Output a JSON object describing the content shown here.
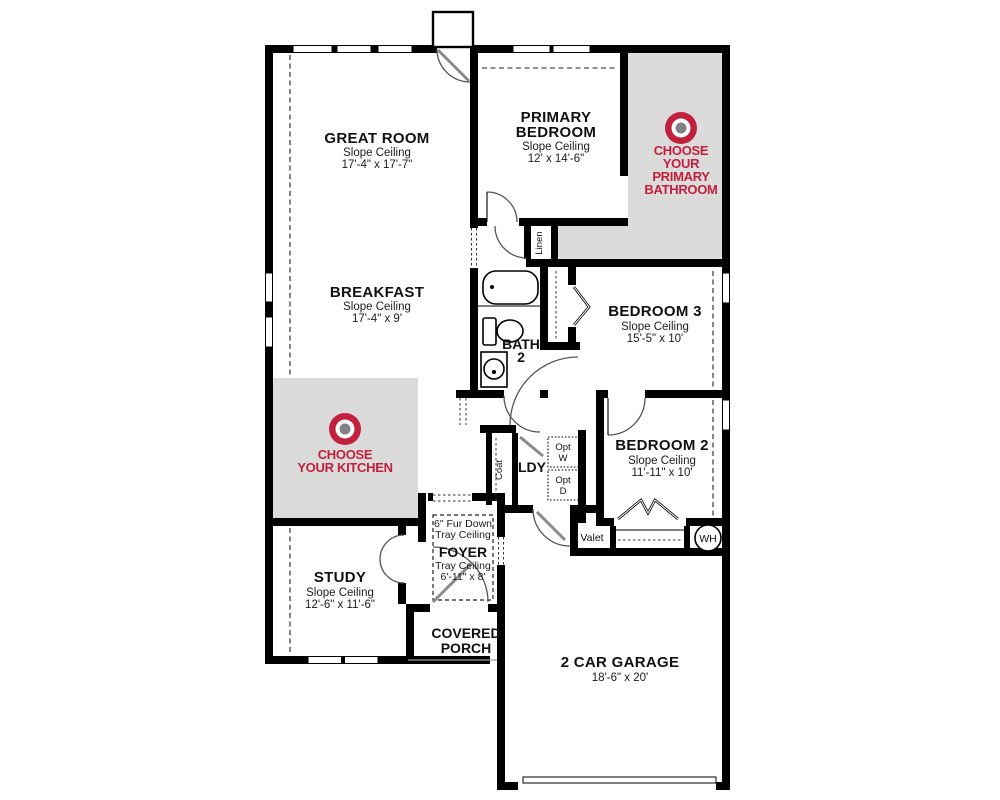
{
  "plan": {
    "rooms": {
      "great_room": {
        "name": "GREAT ROOM",
        "ceiling": "Slope Ceiling",
        "dims": "17'-4\" x 17'-7\""
      },
      "primary_bedroom": {
        "name_line1": "PRIMARY",
        "name_line2": "BEDROOM",
        "ceiling": "Slope Ceiling",
        "dims": "12' x 14'-6\""
      },
      "breakfast": {
        "name": "BREAKFAST",
        "ceiling": "Slope Ceiling",
        "dims": "17'-4\" x 9'"
      },
      "bath2": {
        "name_line1": "BATH",
        "name_line2": "2"
      },
      "bedroom3": {
        "name": "BEDROOM 3",
        "ceiling": "Slope Ceiling",
        "dims": "15'-5\" x 10'"
      },
      "bedroom2": {
        "name": "BEDROOM 2",
        "ceiling": "Slope Ceiling",
        "dims": "11'-11\" x 10'"
      },
      "study": {
        "name": "STUDY",
        "ceiling": "Slope Ceiling",
        "dims": "12'-6\" x 11'-6\""
      },
      "foyer": {
        "note_line1": "6\" Fur Down",
        "note_line2": "Tray Ceiling",
        "name": "FOYER",
        "ceiling": "Tray Ceiling",
        "dims": "6'-11\" x 8'"
      },
      "covered_porch": {
        "name_line1": "COVERED",
        "name_line2": "PORCH"
      },
      "garage": {
        "name": "2 CAR GARAGE",
        "dims": "18'-6\" x 20'"
      }
    },
    "closets": {
      "linen": "Linen",
      "coat": "Coat"
    },
    "laundry": {
      "label": "LDY",
      "opt_washer_line1": "Opt",
      "opt_washer_line2": "W",
      "opt_dryer_line1": "Opt",
      "opt_dryer_line2": "D"
    },
    "labels": {
      "valet": "Valet",
      "water_heater": "WH"
    },
    "badges": {
      "kitchen": {
        "line1": "CHOOSE",
        "line2": "YOUR KITCHEN"
      },
      "primary_bathroom": {
        "line1": "CHOOSE",
        "line2": "YOUR",
        "line3": "PRIMARY",
        "line4": "BATHROOM"
      }
    },
    "colors": {
      "accent_red": "#C2203D",
      "selection_gray": "#DBDBDB",
      "wall_black": "#000000",
      "center_dot_gray": "#808285"
    }
  }
}
